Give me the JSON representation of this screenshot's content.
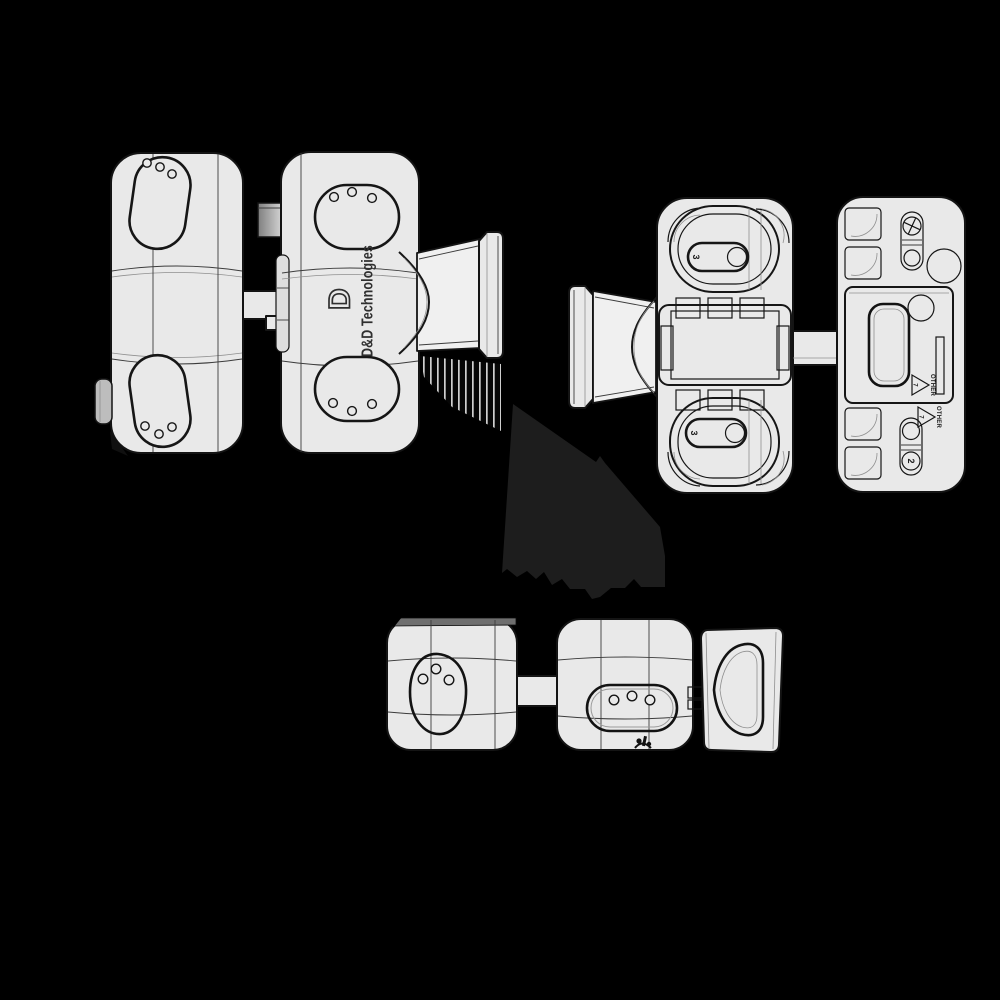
{
  "canvas": {
    "background": "#000000",
    "width": 1000,
    "height": 1000
  },
  "colors": {
    "body_fill": "#e9e9e9",
    "body_highlight": "#f0f0f0",
    "outline": "#141414",
    "seam_line": "#3c3c3c",
    "logo_ink": "#2f2f2f",
    "cast_shadow": "#1d1d1d",
    "top_face_gray": "#6f6f6f",
    "pin_gray": "#a8a8a8"
  },
  "illustration": {
    "brand_initial": "D",
    "brand_text": "D&D Technologies",
    "mold_marks": {
      "top_pill": "3",
      "bottom_pill": "3",
      "screw_slot": "2"
    },
    "recycle": {
      "code": "7",
      "label": "OTHER"
    }
  }
}
